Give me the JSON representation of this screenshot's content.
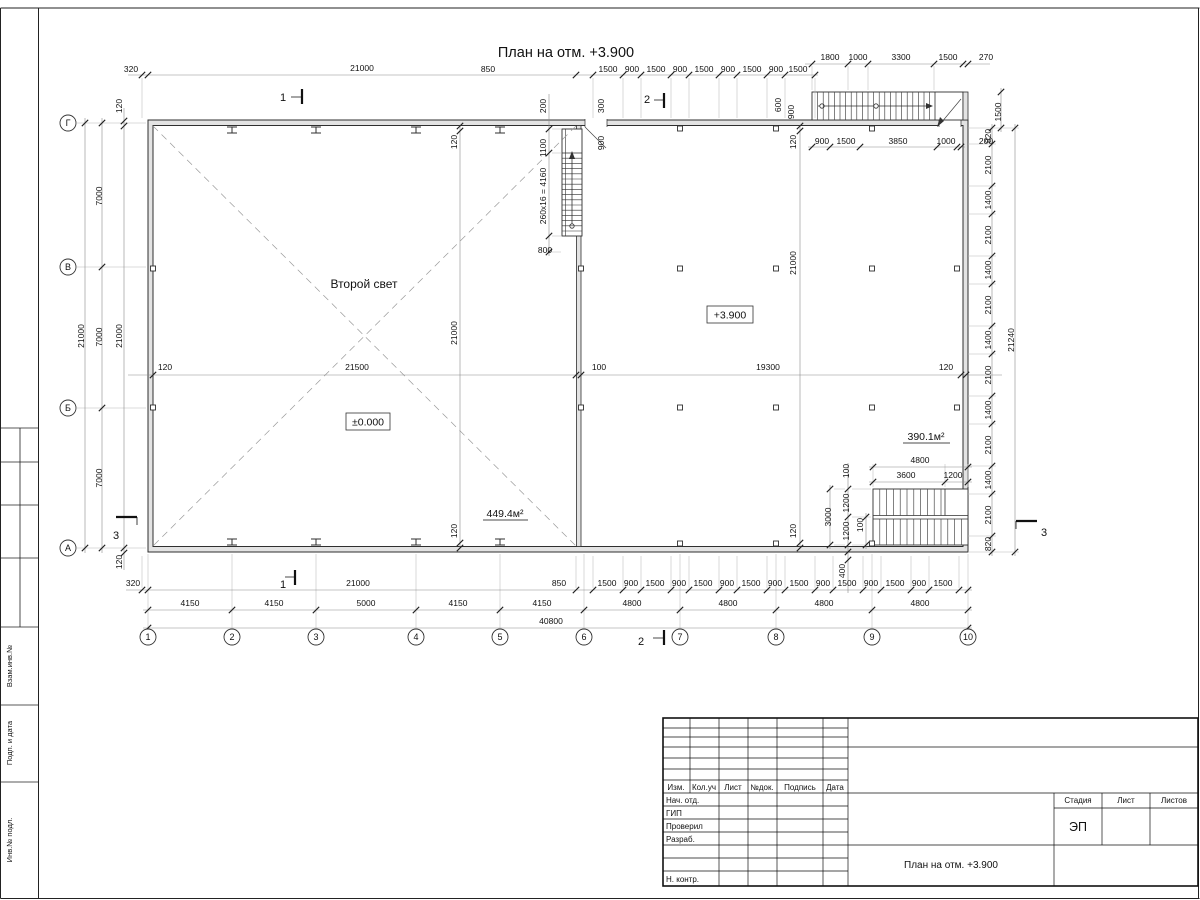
{
  "drawing": {
    "title": "План на отм. +3.900",
    "labels": {
      "second_light": "Второй свет",
      "elev_zero": "±0.000",
      "elev_upper": "+3.900",
      "area_left": "449.4м²",
      "area_right": "390.1м²"
    },
    "axes": {
      "bottom": [
        "1",
        "2",
        "3",
        "4",
        "5",
        "6",
        "7",
        "8",
        "9",
        "10"
      ],
      "left": [
        "Г",
        "В",
        "Б",
        "А"
      ]
    },
    "section_marks": [
      "1",
      "1",
      "2",
      "2",
      "3",
      "3"
    ],
    "dims": [
      {
        "t": "320",
        "x": 131,
        "y": 72,
        "r": 0
      },
      {
        "t": "21000",
        "x": 362,
        "y": 71,
        "r": 0
      },
      {
        "t": "850",
        "x": 488,
        "y": 72,
        "r": 0
      },
      {
        "t": "1500",
        "x": 608,
        "y": 72,
        "r": 0
      },
      {
        "t": "900",
        "x": 632,
        "y": 72,
        "r": 0
      },
      {
        "t": "1500",
        "x": 656,
        "y": 72,
        "r": 0
      },
      {
        "t": "900",
        "x": 680,
        "y": 72,
        "r": 0
      },
      {
        "t": "1500",
        "x": 704,
        "y": 72,
        "r": 0
      },
      {
        "t": "900",
        "x": 728,
        "y": 72,
        "r": 0
      },
      {
        "t": "1500",
        "x": 752,
        "y": 72,
        "r": 0
      },
      {
        "t": "900",
        "x": 776,
        "y": 72,
        "r": 0
      },
      {
        "t": "1500",
        "x": 798,
        "y": 72,
        "r": 0
      },
      {
        "t": "1800",
        "x": 830,
        "y": 60,
        "r": 0
      },
      {
        "t": "1000",
        "x": 858,
        "y": 60,
        "r": 0
      },
      {
        "t": "3300",
        "x": 901,
        "y": 60,
        "r": 0
      },
      {
        "t": "1500",
        "x": 948,
        "y": 60,
        "r": 0
      },
      {
        "t": "270",
        "x": 986,
        "y": 60,
        "r": 0
      },
      {
        "t": "900",
        "x": 822,
        "y": 144,
        "r": 0
      },
      {
        "t": "1500",
        "x": 846,
        "y": 144,
        "r": 0
      },
      {
        "t": "3850",
        "x": 898,
        "y": 144,
        "r": 0
      },
      {
        "t": "1000",
        "x": 946,
        "y": 144,
        "r": 0
      },
      {
        "t": "200",
        "x": 986,
        "y": 144,
        "r": 0
      },
      {
        "t": "200",
        "x": 546,
        "y": 106,
        "r": 1
      },
      {
        "t": "300",
        "x": 604,
        "y": 106,
        "r": 1
      },
      {
        "t": "1100",
        "x": 546,
        "y": 148,
        "r": 1
      },
      {
        "t": "900",
        "x": 604,
        "y": 143,
        "r": 1
      },
      {
        "t": "260x16 = 4160",
        "x": 546,
        "y": 196,
        "r": 1
      },
      {
        "t": "800",
        "x": 545,
        "y": 253,
        "r": 0
      },
      {
        "t": "600",
        "x": 781,
        "y": 105,
        "r": 1
      },
      {
        "t": "900",
        "x": 794,
        "y": 112,
        "r": 1
      },
      {
        "t": "21000",
        "x": 84,
        "y": 336,
        "r": 1
      },
      {
        "t": "7000",
        "x": 102,
        "y": 196,
        "r": 1
      },
      {
        "t": "7000",
        "x": 102,
        "y": 337,
        "r": 1
      },
      {
        "t": "7000",
        "x": 102,
        "y": 478,
        "r": 1
      },
      {
        "t": "120",
        "x": 122,
        "y": 106,
        "r": 1
      },
      {
        "t": "21000",
        "x": 122,
        "y": 336,
        "r": 1
      },
      {
        "t": "120",
        "x": 122,
        "y": 562,
        "r": 1
      },
      {
        "t": "120",
        "x": 165,
        "y": 370,
        "r": 0
      },
      {
        "t": "21500",
        "x": 357,
        "y": 370,
        "r": 0
      },
      {
        "t": "100",
        "x": 599,
        "y": 370,
        "r": 0
      },
      {
        "t": "19300",
        "x": 768,
        "y": 370,
        "r": 0
      },
      {
        "t": "120",
        "x": 946,
        "y": 370,
        "r": 0
      },
      {
        "t": "120",
        "x": 457,
        "y": 142,
        "r": 1
      },
      {
        "t": "21000",
        "x": 457,
        "y": 333,
        "r": 1
      },
      {
        "t": "120",
        "x": 457,
        "y": 531,
        "r": 1
      },
      {
        "t": "120",
        "x": 796,
        "y": 142,
        "r": 1
      },
      {
        "t": "21000",
        "x": 796,
        "y": 263,
        "r": 1
      },
      {
        "t": "120",
        "x": 796,
        "y": 531,
        "r": 1
      },
      {
        "t": "820",
        "x": 991,
        "y": 136,
        "r": 1
      },
      {
        "t": "2100",
        "x": 991,
        "y": 165,
        "r": 1
      },
      {
        "t": "1400",
        "x": 991,
        "y": 200,
        "r": 1
      },
      {
        "t": "2100",
        "x": 991,
        "y": 235,
        "r": 1
      },
      {
        "t": "1400",
        "x": 991,
        "y": 270,
        "r": 1
      },
      {
        "t": "2100",
        "x": 991,
        "y": 305,
        "r": 1
      },
      {
        "t": "1400",
        "x": 991,
        "y": 340,
        "r": 1
      },
      {
        "t": "2100",
        "x": 991,
        "y": 375,
        "r": 1
      },
      {
        "t": "1400",
        "x": 991,
        "y": 410,
        "r": 1
      },
      {
        "t": "2100",
        "x": 991,
        "y": 445,
        "r": 1
      },
      {
        "t": "1400",
        "x": 991,
        "y": 480,
        "r": 1
      },
      {
        "t": "2100",
        "x": 991,
        "y": 515,
        "r": 1
      },
      {
        "t": "820",
        "x": 991,
        "y": 544,
        "r": 1
      },
      {
        "t": "21240",
        "x": 1014,
        "y": 340,
        "r": 1
      },
      {
        "t": "1500",
        "x": 1001,
        "y": 112,
        "r": 1
      },
      {
        "t": "4800",
        "x": 920,
        "y": 463,
        "r": 0
      },
      {
        "t": "3600",
        "x": 906,
        "y": 478,
        "r": 0
      },
      {
        "t": "1200",
        "x": 953,
        "y": 478,
        "r": 0
      },
      {
        "t": "100",
        "x": 849,
        "y": 471,
        "r": 1
      },
      {
        "t": "1200",
        "x": 849,
        "y": 503,
        "r": 1
      },
      {
        "t": "1200",
        "x": 849,
        "y": 531,
        "r": 1
      },
      {
        "t": "3000",
        "x": 831,
        "y": 517,
        "r": 1
      },
      {
        "t": "100",
        "x": 863,
        "y": 525,
        "r": 1
      },
      {
        "t": "400",
        "x": 845,
        "y": 571,
        "r": 1
      },
      {
        "t": "320",
        "x": 133,
        "y": 586,
        "r": 0
      },
      {
        "t": "21000",
        "x": 358,
        "y": 586,
        "r": 0
      },
      {
        "t": "850",
        "x": 559,
        "y": 586,
        "r": 0
      },
      {
        "t": "1500",
        "x": 607,
        "y": 586,
        "r": 0
      },
      {
        "t": "900",
        "x": 631,
        "y": 586,
        "r": 0
      },
      {
        "t": "1500",
        "x": 655,
        "y": 586,
        "r": 0
      },
      {
        "t": "900",
        "x": 679,
        "y": 586,
        "r": 0
      },
      {
        "t": "1500",
        "x": 703,
        "y": 586,
        "r": 0
      },
      {
        "t": "900",
        "x": 727,
        "y": 586,
        "r": 0
      },
      {
        "t": "1500",
        "x": 751,
        "y": 586,
        "r": 0
      },
      {
        "t": "900",
        "x": 775,
        "y": 586,
        "r": 0
      },
      {
        "t": "1500",
        "x": 799,
        "y": 586,
        "r": 0
      },
      {
        "t": "900",
        "x": 823,
        "y": 586,
        "r": 0
      },
      {
        "t": "1500",
        "x": 847,
        "y": 586,
        "r": 0
      },
      {
        "t": "900",
        "x": 871,
        "y": 586,
        "r": 0
      },
      {
        "t": "1500",
        "x": 895,
        "y": 586,
        "r": 0
      },
      {
        "t": "900",
        "x": 919,
        "y": 586,
        "r": 0
      },
      {
        "t": "1500",
        "x": 943,
        "y": 586,
        "r": 0
      },
      {
        "t": "4150",
        "x": 190,
        "y": 606,
        "r": 0
      },
      {
        "t": "4150",
        "x": 274,
        "y": 606,
        "r": 0
      },
      {
        "t": "5000",
        "x": 366,
        "y": 606,
        "r": 0
      },
      {
        "t": "4150",
        "x": 458,
        "y": 606,
        "r": 0
      },
      {
        "t": "4150",
        "x": 542,
        "y": 606,
        "r": 0
      },
      {
        "t": "4800",
        "x": 632,
        "y": 606,
        "r": 0
      },
      {
        "t": "4800",
        "x": 728,
        "y": 606,
        "r": 0
      },
      {
        "t": "4800",
        "x": 824,
        "y": 606,
        "r": 0
      },
      {
        "t": "4800",
        "x": 920,
        "y": 606,
        "r": 0
      },
      {
        "t": "40800",
        "x": 551,
        "y": 624,
        "r": 0
      }
    ]
  },
  "frame": {
    "side_labels": [
      "Взам.инв.№",
      "Подп. и дата",
      "Инв.№ подл."
    ]
  },
  "titleblock": {
    "header": [
      "Изм.",
      "Кол.уч",
      "Лист",
      "№док.",
      "Подпись",
      "Дата"
    ],
    "rows": [
      "Нач. отд.",
      "ГИП",
      "Проверил",
      "Разраб.",
      "",
      "Н. контр."
    ],
    "stage_cols": [
      "Стадия",
      "Лист",
      "Листов"
    ],
    "stage_value": "ЭП",
    "doc_title": "План на отм. +3.900"
  }
}
